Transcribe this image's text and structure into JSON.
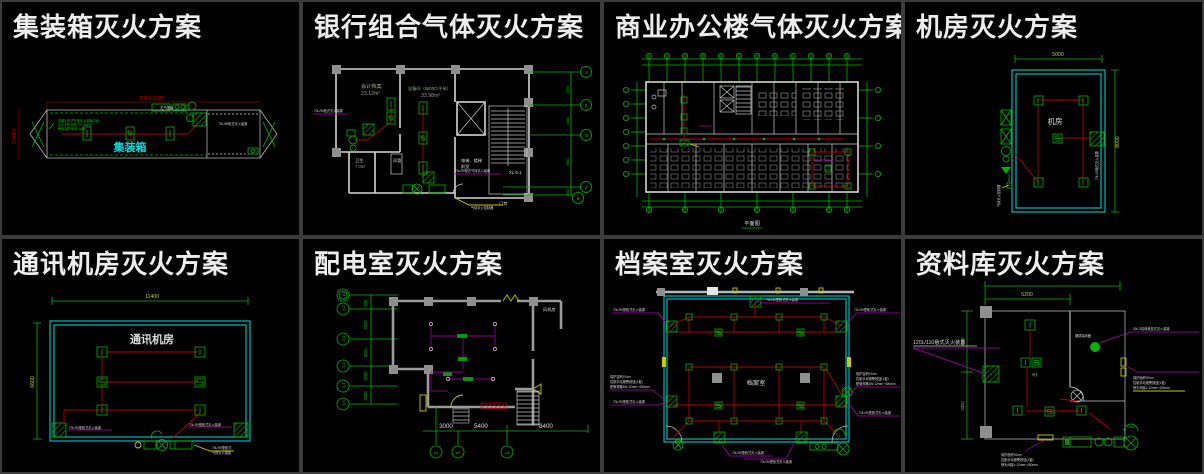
{
  "panels": [
    {
      "title": "集装箱灭火方案",
      "labels": {
        "dim_top": "8960.9386",
        "dim_left": "2348.0",
        "room": "集装箱",
        "cabinet_note": "70L/90柜式灭火装置",
        "spec_1": "说明1:柜式气体灭火装置(3台)",
        "spec_2": "灭火剂贮存压力2.5MPa",
        "spec_3": "喷头保护半径≤4.5m",
        "tank_note": "贮气瓶组"
      }
    },
    {
      "title": "银行组合气体灭火方案",
      "labels": {
        "room1": "会计档案",
        "area1": "23.12m²",
        "room2": "设备间（5600C/平米）",
        "area2": "33.98m²",
        "room3": "卫生",
        "area3": "7.0m²",
        "duct": "风管",
        "lobby1": "电梯、楼梯",
        "lobby2": "前室",
        "door": "门禁",
        "riser": "XL-5-1",
        "leader_left": "70L/90柜式灭火装置",
        "leader_mid": "70L/90柜式气体灭火装置",
        "leader_bottom": "气体灭火控制器",
        "axis": [
          "1",
          "2",
          "4",
          "2",
          "B"
        ],
        "dims": [
          "2300",
          "2400",
          "3600",
          "600"
        ]
      }
    },
    {
      "title": "商业办公楼气体灭火方案",
      "labels": {
        "caption": "平面图"
      }
    },
    {
      "title": "机房灭火方案",
      "labels": {
        "dim_top": "5000",
        "dim_right": "8000",
        "room": "机房",
        "hatch_note": "70L/90柜式灭火装置",
        "corner_note": "气体灭火控制器"
      }
    },
    {
      "title": "通讯机房灭火方案",
      "labels": {
        "dim_top": "11400",
        "dim_left": "6600",
        "room": "通讯机房",
        "left_note": "70L/90型柜式灭火装置",
        "right_note": "70L/90型柜式灭火装置",
        "bottom_note1": "70L/90型柜式",
        "bottom_note2": "气体灭火装置"
      }
    },
    {
      "title": "配电室灭火方案",
      "labels": {
        "fan_room": "风机房",
        "axis_left": [
          "1W",
          "B-1",
          "B-2",
          "B-4",
          "B-5",
          "B-6"
        ],
        "dims_left": [
          "330",
          "4600",
          "3100",
          "2000",
          "2200"
        ],
        "dims_bottom": [
          "3000",
          "5400",
          "8400"
        ],
        "axis_bottom": [
          "a-4",
          "a-5",
          "a-6"
        ]
      }
    },
    {
      "title": "档案室灭火方案",
      "labels": {
        "room": "档案室",
        "note_top": "70L/90型柜式灭火装置",
        "note_tl": "70L/90型柜式灭火装置",
        "note_tr": "70L/90型柜式灭火装置",
        "note_ml1": "保护容积V0:m³",
        "note_ml2": "控制手动报警按钮(1套)",
        "note_ml3": "配管规格DN:12mm~400mm",
        "note_bl": "70L/90型柜式灭火装置",
        "note_mr1": "保护容积V0:m³",
        "note_mr2": "控制手动报警按钮(1套)",
        "note_mr3": "配管规格DN:12mm~400mm",
        "note_br": "70L/90型柜式灭火装置",
        "note_b1": "70L/90型柜式灭火装置",
        "note_b2": "70L/90型柜式灭火装置"
      }
    },
    {
      "title": "资料库灭火方案",
      "labels": {
        "dim_top": "5200",
        "dim_left_a": "3000",
        "dim_left_b": "3300",
        "device_left": "120L/110悬式灭火装置",
        "device_right": "30L/3挂墙悬挂式灭火装置",
        "detector": "烟感探测器",
        "nozzle_note": "喷头",
        "note_r1": "保护面积S0:m²",
        "note_r2": "控制手动报警按钮(1套)",
        "note_r3": "喷头间距L:12mm~400mm",
        "note_b1": "保护面积S0:m²",
        "note_b2": "控制手动报警按钮(1套)",
        "note_b3": "喷头间距L:12mm~400mm"
      }
    }
  ]
}
